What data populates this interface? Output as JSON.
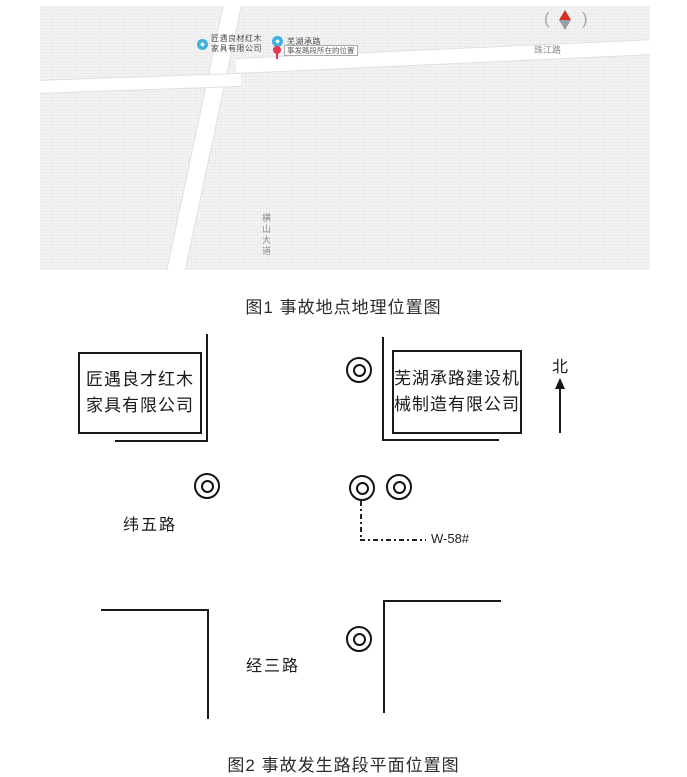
{
  "colors": {
    "poi_blue": "#3fb0e0",
    "pin_red": "#e83550",
    "compass_red": "#d93025",
    "compass_gray": "#9aa0a6",
    "diagram_line": "#1a1a1a",
    "map_bg": "#f1f2f1"
  },
  "figure1": {
    "caption": "图1 事故地点地理位置图",
    "map": {
      "poi1": {
        "line1": "匠遇良材红木",
        "line2": "家具有限公司"
      },
      "poi2": {
        "name": "芜湖承路"
      },
      "pin_label": "事发路段所在的位置",
      "road_right": "珠江路",
      "road_vertical": "横山大道",
      "compass_left": "(",
      "compass_right": ")"
    }
  },
  "figure2": {
    "caption": "图2 事故发生路段平面位置图",
    "north": "北",
    "box_left": {
      "line1": "匠遇良才红木",
      "line2": "家具有限公司"
    },
    "box_right": {
      "line1": "芜湖承路建设机",
      "line2": "械制造有限公司"
    },
    "road_weiwu": "纬五路",
    "road_jingsan": "经三路",
    "well_label": "W-58#"
  }
}
